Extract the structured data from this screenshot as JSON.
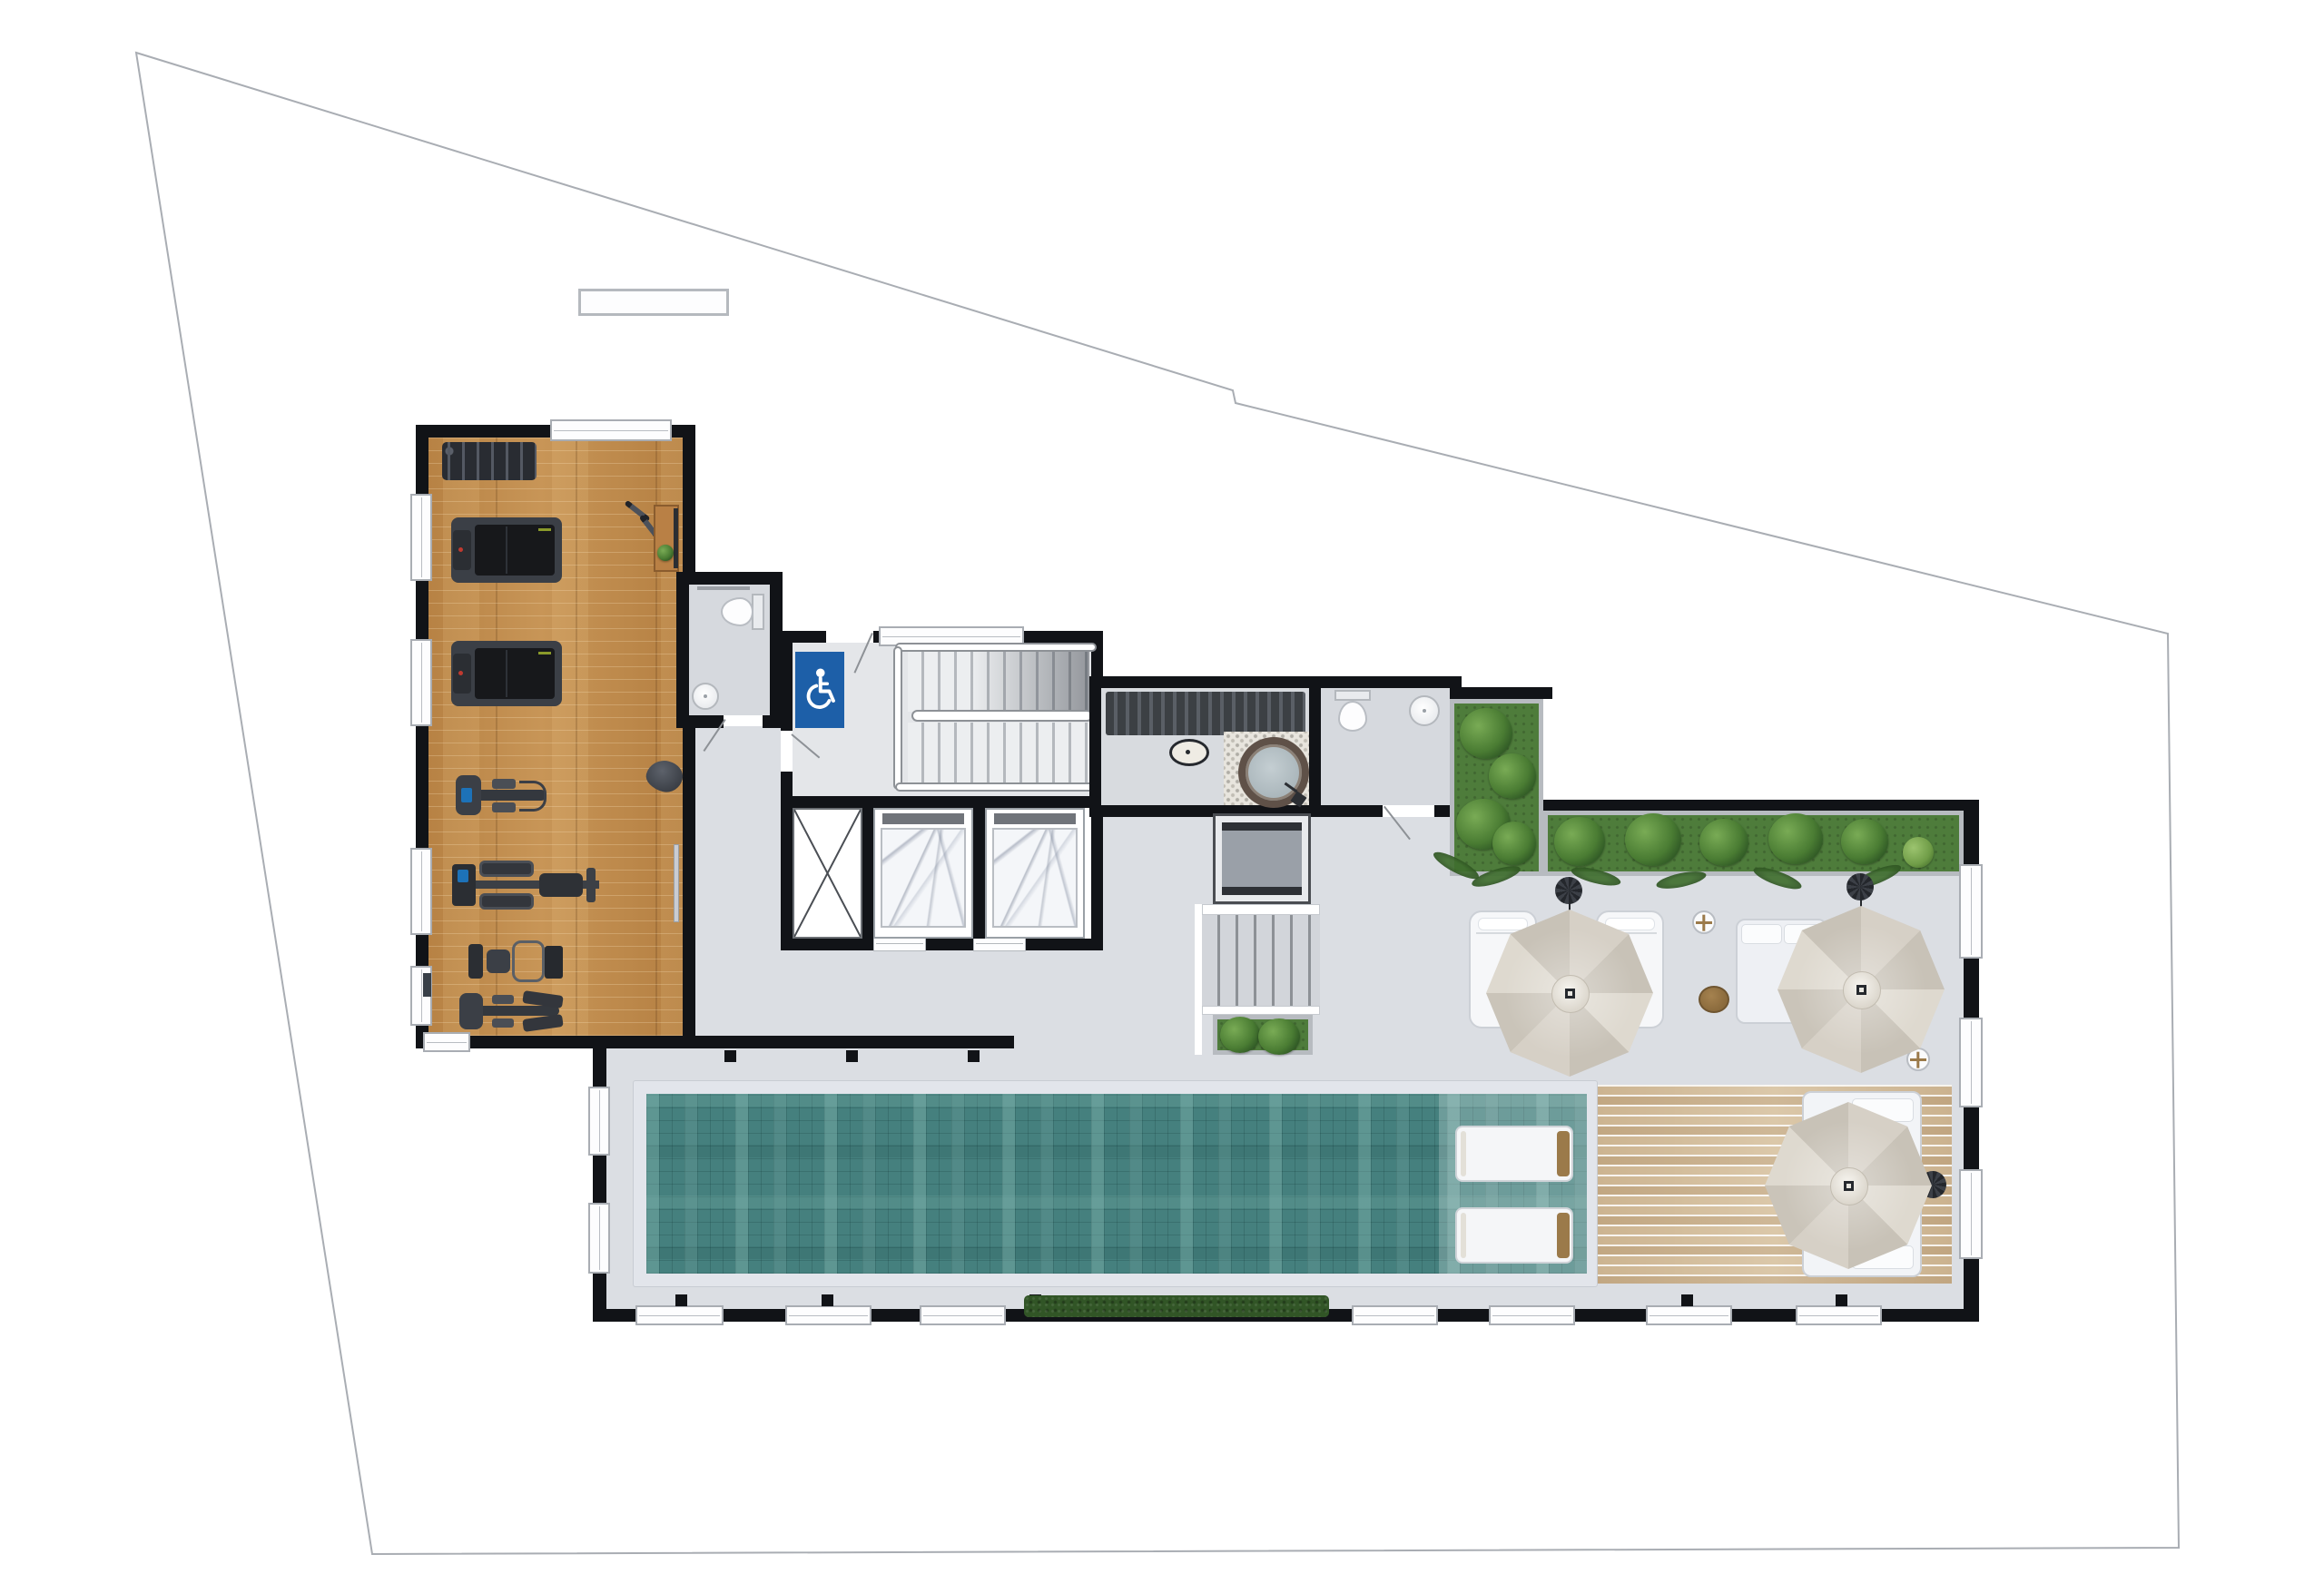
{
  "meta": {
    "type": "architectural floor plan",
    "view": "top-down color render",
    "floor": "rooftop amenities level"
  },
  "icons": {
    "accessibility": "wheelchair-icon"
  },
  "theme": {
    "wall": "#111317",
    "floor": "#dbdee3",
    "wood": "#c08a4a",
    "deck": "#d5bf9d",
    "pool": "#45807e",
    "coping": "#e2e5eb",
    "grass": "#4e7c3b",
    "umbrella": "#d6d0c6",
    "accessBlue": "#1d5fa8",
    "benchSlat": "#3c4044",
    "brown": "#8a6a3c"
  },
  "areas": {
    "site": "Irregular lot boundary",
    "gym": "Fitness room with wood floor",
    "accessible_wc": "Accessible WC with handicap sign",
    "stair_hall": "Main staircase hall",
    "elevators": "Two elevators with marble cabins and service shaft",
    "sauna": "Sauna / spa room with bench and round tub",
    "wc": "WC with toilet and washbasin",
    "planter": "L-shaped planter with tropical plants",
    "terrace": "Roof terrace lounge",
    "terrace_stair": "Terrace stair with platform lift and planter",
    "pool": "Lap pool with mosaic tile and sun shelf",
    "deck": "Timber pool deck",
    "hedge": "Hedge strip at south wall"
  },
  "inventory": {
    "umbrellas": 3,
    "chaise_loungers": 2,
    "in_pool_loungers": 2,
    "daybeds": 2,
    "side_tables": 2,
    "ottomans": 1,
    "treadmills": 2,
    "other_fitness_machines": 4,
    "dumbbell_racks": 1,
    "loose_dumbbell_pairs": 1,
    "elevators": 2,
    "toilets": 2,
    "washbasins": 2,
    "sauna_tubs": 1,
    "planter_boxes": 3,
    "stair_flights": 2
  }
}
